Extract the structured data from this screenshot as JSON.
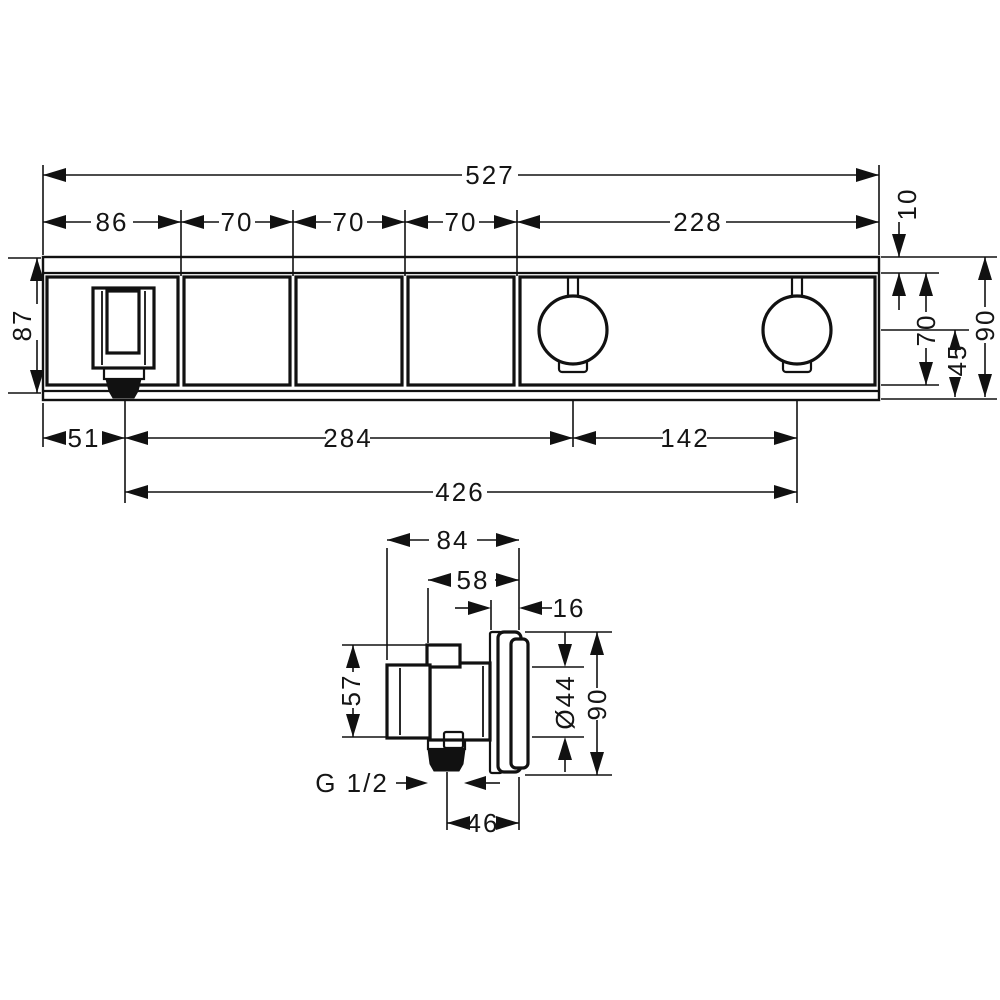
{
  "colors": {
    "line": "#111111",
    "background": "#ffffff"
  },
  "front_view": {
    "total_width": "527",
    "segments": [
      "86",
      "70",
      "70",
      "70",
      "228"
    ],
    "strip_height": "10",
    "inner_height": "70",
    "knob_center_to_bottom": "45",
    "total_height": "90",
    "left_height": "87",
    "spout_offset": "51",
    "spout_to_knob1": "284",
    "knob_spacing": "142",
    "spout_to_knob2": "426"
  },
  "side_view": {
    "total_depth": "84",
    "body_depth": "58",
    "rosette_depth": "16",
    "body_height": "57",
    "hub_diameter": "Ø44",
    "rosette_diameter": "90",
    "thread_label": "G 1/2",
    "outlet_to_face": "46"
  }
}
